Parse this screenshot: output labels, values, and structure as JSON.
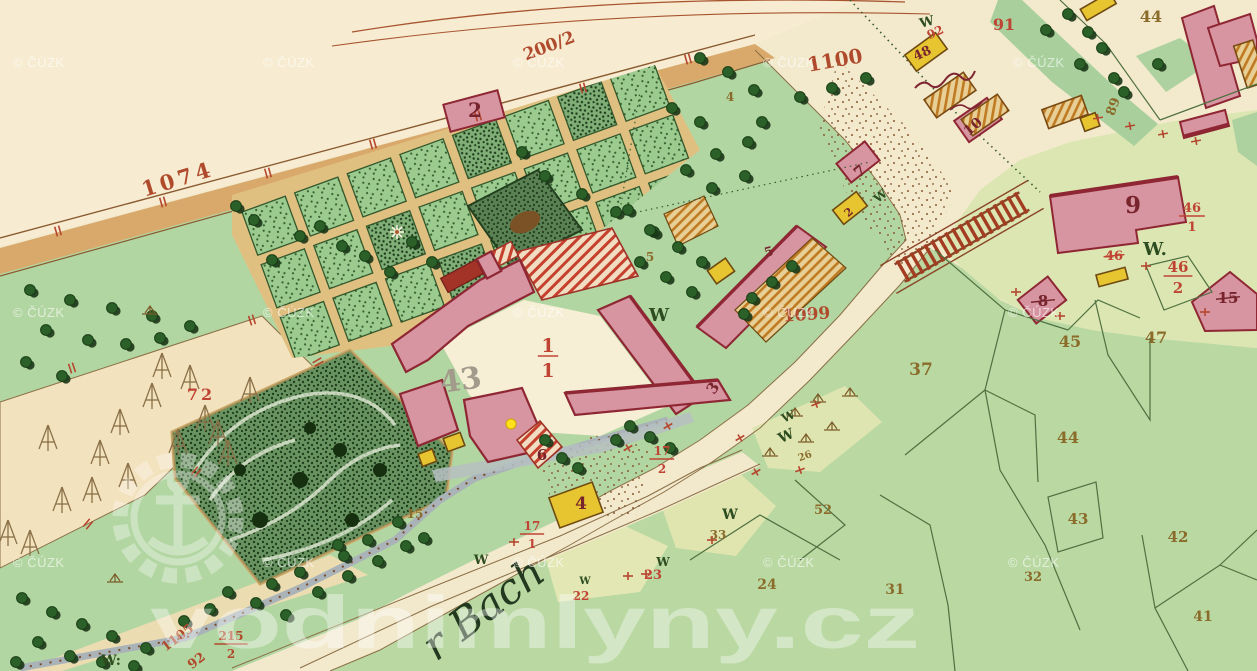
{
  "palette": {
    "road": "#b04a2c",
    "house": "#77242c",
    "red": "#c04434",
    "parcel": "#8a6b2a",
    "w": "#2d4c20",
    "pencil": "#a29a8b",
    "stream": "#22381f",
    "watermark": "#ffffff",
    "marker": "#ffe21c"
  },
  "labels": [
    {
      "t": "1074",
      "x": 180,
      "y": 186,
      "s": 21,
      "c": "road",
      "r": -17,
      "sp": 4
    },
    {
      "t": "200/2",
      "x": 551,
      "y": 51,
      "s": 17,
      "c": "road",
      "r": -21
    },
    {
      "t": "1100",
      "x": 836,
      "y": 67,
      "s": 20,
      "c": "road",
      "r": -10
    },
    {
      "t": "1099",
      "x": 807,
      "y": 320,
      "s": 17,
      "c": "road",
      "r": -4
    },
    {
      "t": "1105",
      "x": 180,
      "y": 641,
      "s": 13,
      "c": "road",
      "r": -37
    },
    {
      "t": "92",
      "x": 199,
      "y": 664,
      "s": 13,
      "c": "road",
      "r": -37
    },
    {
      "t": "2",
      "x": 475,
      "y": 117,
      "s": 20,
      "c": "house"
    },
    {
      "t": "6",
      "x": 542,
      "y": 460,
      "s": 15,
      "c": "house"
    },
    {
      "t": "4",
      "x": 581,
      "y": 509,
      "s": 17,
      "c": "house"
    },
    {
      "t": "3",
      "x": 717,
      "y": 391,
      "s": 15,
      "c": "house",
      "r": -55
    },
    {
      "t": "5",
      "x": 770,
      "y": 256,
      "s": 13,
      "c": "house",
      "r": -15
    },
    {
      "t": "7",
      "x": 863,
      "y": 175,
      "s": 15,
      "c": "house",
      "r": -40
    },
    {
      "t": "2",
      "x": 851,
      "y": 215,
      "s": 11,
      "c": "house",
      "r": -40
    },
    {
      "t": "9",
      "x": 1133,
      "y": 213,
      "s": 23,
      "c": "house"
    },
    {
      "t": "8",
      "x": 1043,
      "y": 306,
      "s": 15,
      "c": "house",
      "crossed": true
    },
    {
      "t": "15",
      "x": 1228,
      "y": 303,
      "s": 15,
      "c": "house",
      "crossed": true
    },
    {
      "t": "10",
      "x": 976,
      "y": 130,
      "s": 14,
      "c": "house",
      "r": -42
    },
    {
      "t": "48",
      "x": 924,
      "y": 57,
      "s": 13,
      "c": "house",
      "r": -25
    },
    {
      "t": "92",
      "x": 937,
      "y": 36,
      "s": 12,
      "c": "red",
      "r": -25
    },
    {
      "t": "91",
      "x": 1004,
      "y": 30,
      "s": 16,
      "c": "red"
    },
    {
      "t": "72",
      "x": 201,
      "y": 400,
      "s": 16,
      "c": "red",
      "sp": 3
    },
    {
      "t": "44",
      "x": 1151,
      "y": 22,
      "s": 16,
      "c": "parcel"
    },
    {
      "t": "89",
      "x": 1117,
      "y": 108,
      "s": 13,
      "c": "parcel",
      "r": -70
    },
    {
      "t": "37",
      "x": 921,
      "y": 375,
      "s": 17,
      "c": "parcel"
    },
    {
      "t": "45",
      "x": 1070,
      "y": 347,
      "s": 16,
      "c": "parcel"
    },
    {
      "t": "47",
      "x": 1156,
      "y": 343,
      "s": 16,
      "c": "parcel"
    },
    {
      "t": "44",
      "x": 1068,
      "y": 443,
      "s": 16,
      "c": "parcel"
    },
    {
      "t": "43",
      "x": 1078,
      "y": 524,
      "s": 15,
      "c": "parcel"
    },
    {
      "t": "42",
      "x": 1178,
      "y": 542,
      "s": 15,
      "c": "parcel"
    },
    {
      "t": "41",
      "x": 1203,
      "y": 621,
      "s": 14,
      "c": "parcel"
    },
    {
      "t": "31",
      "x": 895,
      "y": 594,
      "s": 14,
      "c": "parcel"
    },
    {
      "t": "32",
      "x": 1033,
      "y": 581,
      "s": 13,
      "c": "parcel"
    },
    {
      "t": "24",
      "x": 767,
      "y": 589,
      "s": 14,
      "c": "parcel"
    },
    {
      "t": "52",
      "x": 823,
      "y": 514,
      "s": 13,
      "c": "parcel"
    },
    {
      "t": "33",
      "x": 718,
      "y": 539,
      "s": 12,
      "c": "parcel"
    },
    {
      "t": "23",
      "x": 653,
      "y": 579,
      "s": 13,
      "c": "red"
    },
    {
      "t": "22",
      "x": 581,
      "y": 600,
      "s": 12,
      "c": "red"
    },
    {
      "t": "15",
      "x": 415,
      "y": 518,
      "s": 12,
      "c": "parcel"
    },
    {
      "t": "5",
      "x": 650,
      "y": 261,
      "s": 12,
      "c": "parcel"
    },
    {
      "t": "4",
      "x": 730,
      "y": 101,
      "s": 12,
      "c": "parcel"
    },
    {
      "t": "26",
      "x": 806,
      "y": 459,
      "s": 10,
      "c": "parcel",
      "r": -20
    },
    {
      "t": "W",
      "x": 928,
      "y": 26,
      "s": 13,
      "c": "w",
      "r": -15
    },
    {
      "t": "W.",
      "x": 1155,
      "y": 255,
      "s": 18,
      "c": "w"
    },
    {
      "t": "W",
      "x": 659,
      "y": 321,
      "s": 18,
      "c": "w"
    },
    {
      "t": "W",
      "x": 883,
      "y": 199,
      "s": 12,
      "c": "w",
      "r": -40
    },
    {
      "t": "W",
      "x": 788,
      "y": 440,
      "s": 14,
      "c": "w",
      "r": -25
    },
    {
      "t": "W",
      "x": 790,
      "y": 420,
      "s": 12,
      "c": "w",
      "r": -25
    },
    {
      "t": "W",
      "x": 730,
      "y": 519,
      "s": 14,
      "c": "w"
    },
    {
      "t": "W",
      "x": 663,
      "y": 566,
      "s": 12,
      "c": "w"
    },
    {
      "t": "W",
      "x": 481,
      "y": 564,
      "s": 13,
      "c": "w"
    },
    {
      "t": "W",
      "x": 585,
      "y": 584,
      "s": 10,
      "c": "w"
    },
    {
      "t": "W:",
      "x": 111,
      "y": 665,
      "s": 14,
      "c": "w"
    },
    {
      "t": "43",
      "x": 462,
      "y": 390,
      "s": 30,
      "c": "pencil",
      "r": -8
    },
    {
      "t": "46",
      "x": 1114,
      "y": 260,
      "s": 13,
      "c": "red",
      "crossed": true
    }
  ],
  "fractions": [
    {
      "n": "1",
      "d": "1",
      "x": 548,
      "y": 352,
      "s": 19,
      "c": "red"
    },
    {
      "n": "46",
      "d": "1",
      "x": 1192,
      "y": 212,
      "s": 13,
      "c": "red"
    },
    {
      "n": "46",
      "d": "2",
      "x": 1178,
      "y": 272,
      "s": 15,
      "c": "red"
    },
    {
      "n": "17",
      "d": "1",
      "x": 532,
      "y": 530,
      "s": 12,
      "c": "red"
    },
    {
      "n": "17",
      "d": "2",
      "x": 662,
      "y": 455,
      "s": 12,
      "c": "red"
    },
    {
      "n": "215",
      "d": "2",
      "x": 231,
      "y": 640,
      "s": 12,
      "c": "road"
    }
  ],
  "stream_name": {
    "text": "r Bach",
    "x": 436,
    "y": 662,
    "r": -37,
    "s": 42
  },
  "marker": {
    "x": 511,
    "y": 424,
    "r": 5
  },
  "watermarks": {
    "cuzk_text": "© ČÚZK",
    "cuzk_positions": [
      [
        13,
        67
      ],
      [
        263,
        67
      ],
      [
        513,
        67
      ],
      [
        763,
        67
      ],
      [
        1013,
        67
      ],
      [
        13,
        317
      ],
      [
        263,
        317
      ],
      [
        513,
        317
      ],
      [
        763,
        317
      ],
      [
        1008,
        317
      ],
      [
        13,
        567
      ],
      [
        263,
        567
      ],
      [
        513,
        567
      ],
      [
        763,
        567
      ],
      [
        1008,
        567
      ]
    ],
    "site_text": "vodnimlyny.cz",
    "site": {
      "x": 150,
      "y": 648,
      "size": 74,
      "length": 770
    }
  }
}
